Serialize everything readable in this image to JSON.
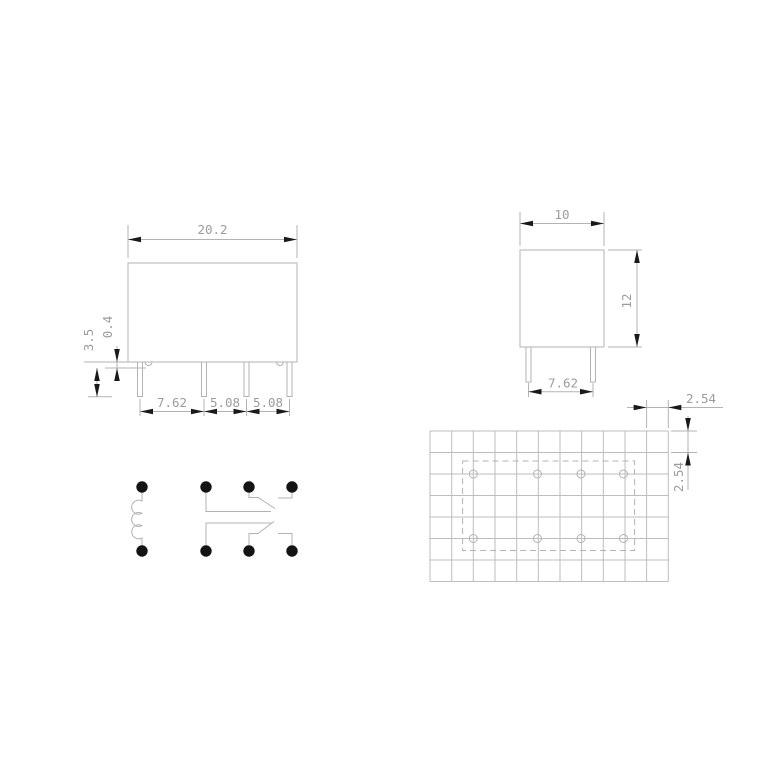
{
  "colors": {
    "background": "#ffffff",
    "line": "#b3b3b3",
    "grid_line": "#bdbdbd",
    "dimension_text": "#9c9c9c",
    "arrowhead": "#1a1a1a",
    "schematic_dot": "#141414"
  },
  "front_view": {
    "body_width": "20.2",
    "standoff_height": "0.4",
    "pin_length": "3.5",
    "pin_pitch_1": "7.62",
    "pin_pitch_2": "5.08",
    "pin_pitch_3": "5.08"
  },
  "side_view": {
    "body_depth": "10",
    "body_height": "12",
    "pin_pitch": "7.62"
  },
  "pcb_layout": {
    "hole_pitch_x": "2.54",
    "hole_pitch_y": "2.54"
  }
}
